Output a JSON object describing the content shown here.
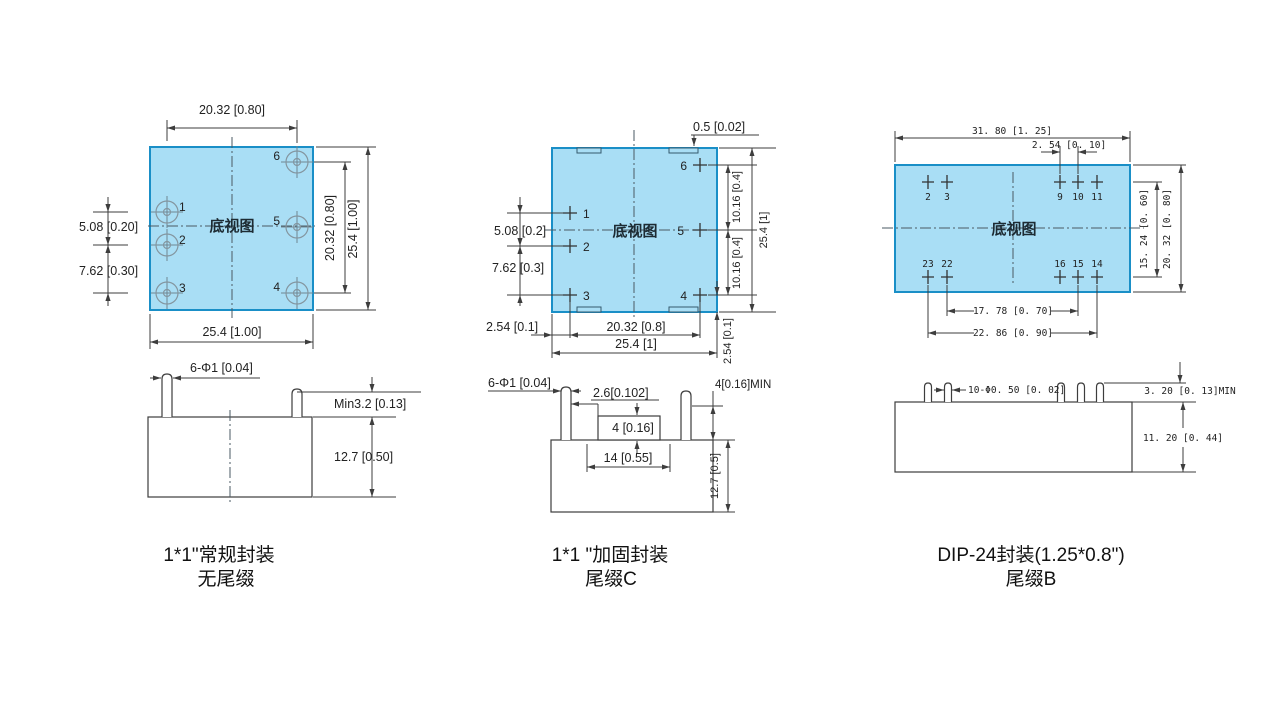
{
  "view_label": "底视图",
  "colors": {
    "body_fill": "#a9def5",
    "body_stroke": "#1a8fc7",
    "line": "#3d3d3d",
    "pin_pad": "#8496a0"
  },
  "packages": {
    "p1": {
      "caption1": "1*1\"常规封装",
      "caption2": "无尾缀",
      "pins": [
        "1",
        "2",
        "3",
        "4",
        "5",
        "6"
      ],
      "dims": {
        "pitch_x": "20.32 [0.80]",
        "width": "25.4 [1.00]",
        "pitch_y": "20.32 [0.80]",
        "height": "25.4 [1.00]",
        "row12": "5.08 [0.20]",
        "row23": "7.62 [0.30]",
        "pin_dia": "6-Φ1 [0.04]",
        "pin_len": "Min3.2 [0.13]",
        "body_h": "12.7 [0.50]"
      }
    },
    "p2": {
      "caption1": "1*1 \"加固封装",
      "caption2": "尾缀C",
      "pins": [
        "1",
        "2",
        "3",
        "4",
        "5",
        "6"
      ],
      "dims": {
        "notch": "0.5 [0.02]",
        "row65": "10.16 [0.4]",
        "row54": "10.16 [0.4]",
        "height": "25.4 [1]",
        "row4_edge": "2.54 [0.1]",
        "row12": "5.08 [0.2]",
        "row23": "7.62 [0.3]",
        "col_edge": "2.54 [0.1]",
        "pitch_x": "20.32 [0.8]",
        "width": "25.4 [1]",
        "pin_dia": "6-Φ1 [0.04]",
        "step_w": "2.6[0.102]",
        "step_h": "4 [0.16]",
        "recess_w": "14 [0.55]",
        "pin_len": "4[0.16]MIN",
        "body_h": "12.7 [0.5]"
      }
    },
    "p3": {
      "caption1": "DIP-24封装(1.25*0.8\")",
      "caption2": "尾缀B",
      "pins_top": [
        "2",
        "3",
        "9",
        "10",
        "11"
      ],
      "pins_bottom": [
        "23",
        "22",
        "16",
        "15",
        "14"
      ],
      "dims": {
        "width": "31. 80 [1. 25]",
        "pitch": "2. 54 [0. 10]",
        "row_span": "15. 24 [0. 60]",
        "height": "20. 32 [0. 80]",
        "span_inner": "17. 78 [0. 70]",
        "span_outer": "22. 86 [0. 90]",
        "pin_dia": "10-Φ0. 50 [0. 02]",
        "pin_len": "3. 20 [0. 13]MIN",
        "body_h": "11. 20 [0. 44]"
      }
    }
  }
}
